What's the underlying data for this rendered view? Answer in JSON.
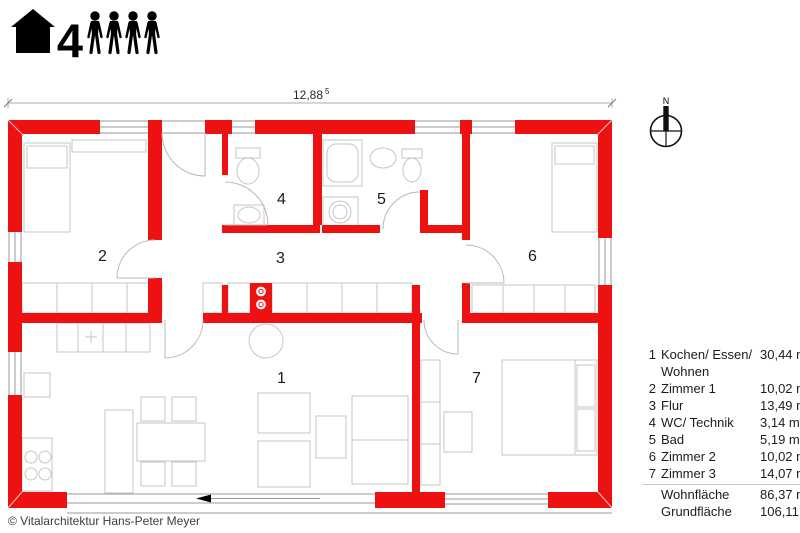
{
  "header": {
    "occupant_count": "4",
    "house_icon": "house-icon",
    "person_icon": "person-icon"
  },
  "dimension": {
    "value": "12,88",
    "superscript": "5"
  },
  "compass": {
    "north_label": "N",
    "icon": "north-compass-icon"
  },
  "plan": {
    "room_numbers": [
      "1",
      "2",
      "3",
      "4",
      "5",
      "6",
      "7"
    ]
  },
  "legend": {
    "rows": [
      {
        "number": "1",
        "name": "Kochen/ Essen/ Wohnen",
        "area": "30,44 m²"
      },
      {
        "number": "2",
        "name": "Zimmer 1",
        "area": "10,02 m²"
      },
      {
        "number": "3",
        "name": "Flur",
        "area": "13,49 m²"
      },
      {
        "number": "4",
        "name": "WC/ Technik",
        "area": "3,14 m²"
      },
      {
        "number": "5",
        "name": "Bad",
        "area": "5,19 m²"
      },
      {
        "number": "6",
        "name": "Zimmer 2",
        "area": "10,02 m²"
      },
      {
        "number": "7",
        "name": "Zimmer 3",
        "area": "14,07 m²"
      }
    ],
    "totals": [
      {
        "name": "Wohnfläche",
        "area": "86,37 m²"
      },
      {
        "name": "Grundfläche",
        "area": "106,11 m²"
      }
    ]
  },
  "footer": {
    "copyright": "© Vitalarchitektur Hans-Peter Meyer"
  },
  "colors": {
    "wall_red": "#ee1111",
    "furniture_outline": "#c6c6c6",
    "window_line": "#9a9a9a",
    "text": "#1c1c1c"
  }
}
